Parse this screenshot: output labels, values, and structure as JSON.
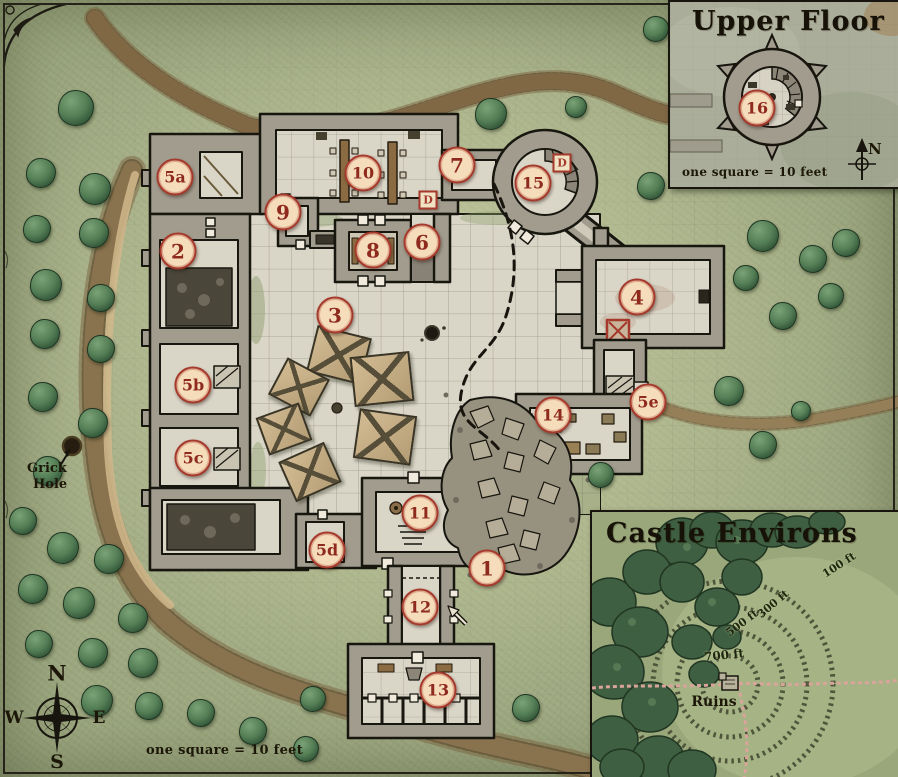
{
  "map_labels": {
    "grick_line1": "Grick",
    "grick_line2": "Hole",
    "scale": "one square = 10 feet",
    "compass": {
      "n": "N",
      "s": "S",
      "e": "E",
      "w": "W"
    }
  },
  "insets": {
    "upper_floor": {
      "title": "Upper Floor",
      "scale": "one square = 10 feet",
      "compass_n": "N"
    },
    "environs": {
      "title": "Castle Environs",
      "ruins": "Ruins",
      "rings": [
        {
          "label": "100 ft"
        },
        {
          "label": "300 ft"
        },
        {
          "label": "500 ft"
        },
        {
          "label": "700 ft"
        }
      ]
    }
  },
  "markers": [
    {
      "id": "1",
      "x": 487,
      "y": 568
    },
    {
      "id": "2",
      "x": 178,
      "y": 251
    },
    {
      "id": "3",
      "x": 335,
      "y": 315
    },
    {
      "id": "4",
      "x": 637,
      "y": 297
    },
    {
      "id": "5a",
      "x": 175,
      "y": 177
    },
    {
      "id": "5b",
      "x": 193,
      "y": 385
    },
    {
      "id": "5c",
      "x": 193,
      "y": 458
    },
    {
      "id": "5d",
      "x": 327,
      "y": 550
    },
    {
      "id": "5e",
      "x": 648,
      "y": 402
    },
    {
      "id": "6",
      "x": 422,
      "y": 242
    },
    {
      "id": "7",
      "x": 457,
      "y": 165
    },
    {
      "id": "8",
      "x": 373,
      "y": 250
    },
    {
      "id": "9",
      "x": 283,
      "y": 212
    },
    {
      "id": "10",
      "x": 363,
      "y": 173
    },
    {
      "id": "11",
      "x": 420,
      "y": 513
    },
    {
      "id": "12",
      "x": 420,
      "y": 607
    },
    {
      "id": "13",
      "x": 438,
      "y": 690
    },
    {
      "id": "14",
      "x": 553,
      "y": 415
    },
    {
      "id": "15",
      "x": 533,
      "y": 183
    },
    {
      "id": "16",
      "x": 757,
      "y": 108
    }
  ],
  "door_labels": [
    {
      "label": "D",
      "x": 428,
      "y": 200
    },
    {
      "label": "D",
      "x": 562,
      "y": 163
    }
  ],
  "trees": [
    [
      75,
      107,
      17
    ],
    [
      40,
      172,
      14
    ],
    [
      94,
      188,
      15
    ],
    [
      36,
      228,
      13
    ],
    [
      93,
      232,
      14
    ],
    [
      45,
      284,
      15
    ],
    [
      100,
      297,
      13
    ],
    [
      44,
      333,
      14
    ],
    [
      100,
      348,
      13
    ],
    [
      42,
      396,
      14
    ],
    [
      92,
      422,
      14
    ],
    [
      47,
      470,
      14
    ],
    [
      22,
      520,
      13
    ],
    [
      62,
      547,
      15
    ],
    [
      108,
      558,
      14
    ],
    [
      32,
      588,
      14
    ],
    [
      78,
      602,
      15
    ],
    [
      132,
      617,
      14
    ],
    [
      38,
      643,
      13
    ],
    [
      92,
      652,
      14
    ],
    [
      142,
      662,
      14
    ],
    [
      96,
      700,
      15
    ],
    [
      148,
      705,
      13
    ],
    [
      200,
      712,
      13
    ],
    [
      252,
      730,
      13
    ],
    [
      305,
      748,
      12
    ],
    [
      490,
      113,
      15
    ],
    [
      575,
      106,
      10
    ],
    [
      650,
      185,
      13
    ],
    [
      655,
      28,
      12
    ],
    [
      762,
      235,
      15
    ],
    [
      812,
      258,
      13
    ],
    [
      745,
      277,
      12
    ],
    [
      845,
      242,
      13
    ],
    [
      830,
      295,
      12
    ],
    [
      782,
      315,
      13
    ],
    [
      728,
      390,
      14
    ],
    [
      762,
      444,
      13
    ],
    [
      800,
      410,
      9
    ],
    [
      600,
      474,
      12
    ],
    [
      312,
      698,
      12
    ],
    [
      525,
      707,
      13
    ]
  ],
  "tents": [
    {
      "x": 337,
      "y": 353,
      "w": 52,
      "h": 44,
      "rot": 14
    },
    {
      "x": 297,
      "y": 385,
      "w": 44,
      "h": 38,
      "rot": 28
    },
    {
      "x": 380,
      "y": 377,
      "w": 56,
      "h": 46,
      "rot": -6
    },
    {
      "x": 282,
      "y": 427,
      "w": 42,
      "h": 36,
      "rot": -20
    },
    {
      "x": 383,
      "y": 435,
      "w": 54,
      "h": 46,
      "rot": 8
    },
    {
      "x": 308,
      "y": 470,
      "w": 46,
      "h": 40,
      "rot": -24
    }
  ],
  "colors": {
    "marker_fill": "#f5dcba",
    "marker_ring": "#a5392b",
    "marker_text": "#8e2a1e",
    "stone_wall": "#a29c8e",
    "stone_floor": "#d9d5c7",
    "parchment_green": "#a4b086",
    "trail_pink": "#d9a49a",
    "cliff_tan": "#b5946a"
  }
}
